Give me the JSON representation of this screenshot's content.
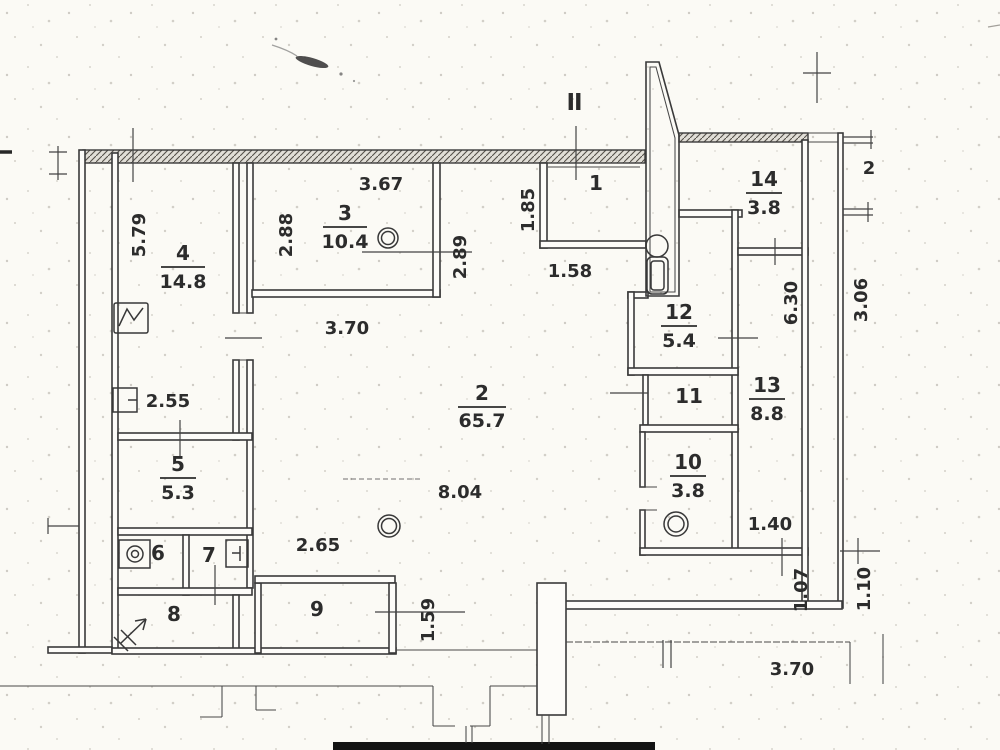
{
  "plan": {
    "title": "apartment-floor-plan-scan",
    "section_mark": "II",
    "rooms": [
      {
        "number": "1",
        "area": ""
      },
      {
        "number": "2",
        "area": "65.7"
      },
      {
        "number": "3",
        "area": "10.4"
      },
      {
        "number": "4",
        "area": "14.8"
      },
      {
        "number": "5",
        "area": "5.3"
      },
      {
        "number": "6",
        "area": ""
      },
      {
        "number": "7",
        "area": ""
      },
      {
        "number": "8",
        "area": ""
      },
      {
        "number": "9",
        "area": ""
      },
      {
        "number": "10",
        "area": "3.8"
      },
      {
        "number": "11",
        "area": ""
      },
      {
        "number": "12",
        "area": "5.4"
      },
      {
        "number": "13",
        "area": "8.8"
      },
      {
        "number": "14",
        "area": "3.8"
      }
    ],
    "dimensions": [
      {
        "value": "5.79"
      },
      {
        "value": "3.67"
      },
      {
        "value": "2.88"
      },
      {
        "value": "2.89"
      },
      {
        "value": "1.85"
      },
      {
        "value": "1.58"
      },
      {
        "value": "3.70"
      },
      {
        "value": "2.55"
      },
      {
        "value": "8.04"
      },
      {
        "value": "2.65"
      },
      {
        "value": "1.59"
      },
      {
        "value": "6.30"
      },
      {
        "value": "3.06"
      },
      {
        "value": "1.40"
      },
      {
        "value": "1.07"
      },
      {
        "value": "1.10"
      },
      {
        "value": "3.70"
      },
      {
        "value": "2"
      }
    ],
    "fixtures": {
      "room3_symbol": "ceiling-light",
      "room2_symbol": "ceiling-light",
      "room10_symbol": "ceiling-light",
      "room12_symbol": "toilet",
      "room4_symbol": "sink",
      "room5_symbol": "radiator",
      "room6_symbol": "washing-machine",
      "room7_symbol": "wash-basin",
      "room8_symbol": "door-swing-arrow",
      "shaft": "ventilation-shaft"
    }
  }
}
